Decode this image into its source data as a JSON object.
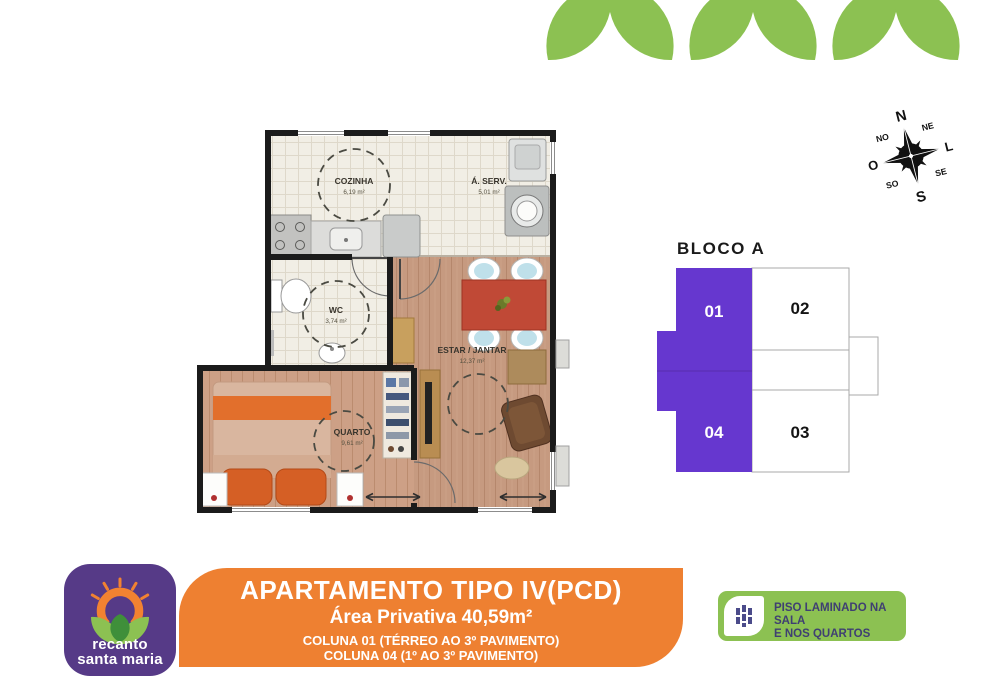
{
  "flyer": {
    "brand": {
      "line1": "recanto",
      "line2": "santa maria",
      "bg_color": "#563A87"
    },
    "banner": {
      "bg_color": "#EE8031",
      "title": "APARTAMENTO TIPO IV(PCD)",
      "subtitle": "Área Privativa 40,59m²",
      "coluna1": "COLUNA 01 (TÉRREO AO 3º PAVIMENTO)",
      "coluna2": "COLUNA 04 (1º AO 3º PAVIMENTO)",
      "note": "*Unidades PCD contemplam apenas 1 quarto"
    },
    "feature_badge": {
      "bg_color": "#8CC152",
      "line1": "PISO LAMINADO NA SALA",
      "line2": "E NOS QUARTOS",
      "text_color": "#3F3F72"
    }
  },
  "floorplan": {
    "wall_color": "#1b1b1b",
    "tile_color": "#f1eee5",
    "wood_color": "#c69a80",
    "rooms": [
      {
        "name": "COZINHA",
        "area": "6,19 m²"
      },
      {
        "name": "Á. SERV.",
        "area": "5,01 m²"
      },
      {
        "name": "WC",
        "area": "3,74 m²"
      },
      {
        "name": "ESTAR / JANTAR",
        "area": "12,37 m²"
      },
      {
        "name": "QUARTO",
        "area": "9,61 m²"
      }
    ]
  },
  "bloco": {
    "title": "BLOCO A",
    "highlight_color": "#6637CF",
    "units": [
      {
        "label": "01",
        "highlighted": true
      },
      {
        "label": "02",
        "highlighted": false
      },
      {
        "label": "03",
        "highlighted": false
      },
      {
        "label": "04",
        "highlighted": true
      }
    ]
  },
  "compass": {
    "n": "N",
    "s": "S",
    "e": "L",
    "w": "O",
    "ne": "NE",
    "nw": "NO",
    "se": "SE",
    "sw": "SO"
  }
}
